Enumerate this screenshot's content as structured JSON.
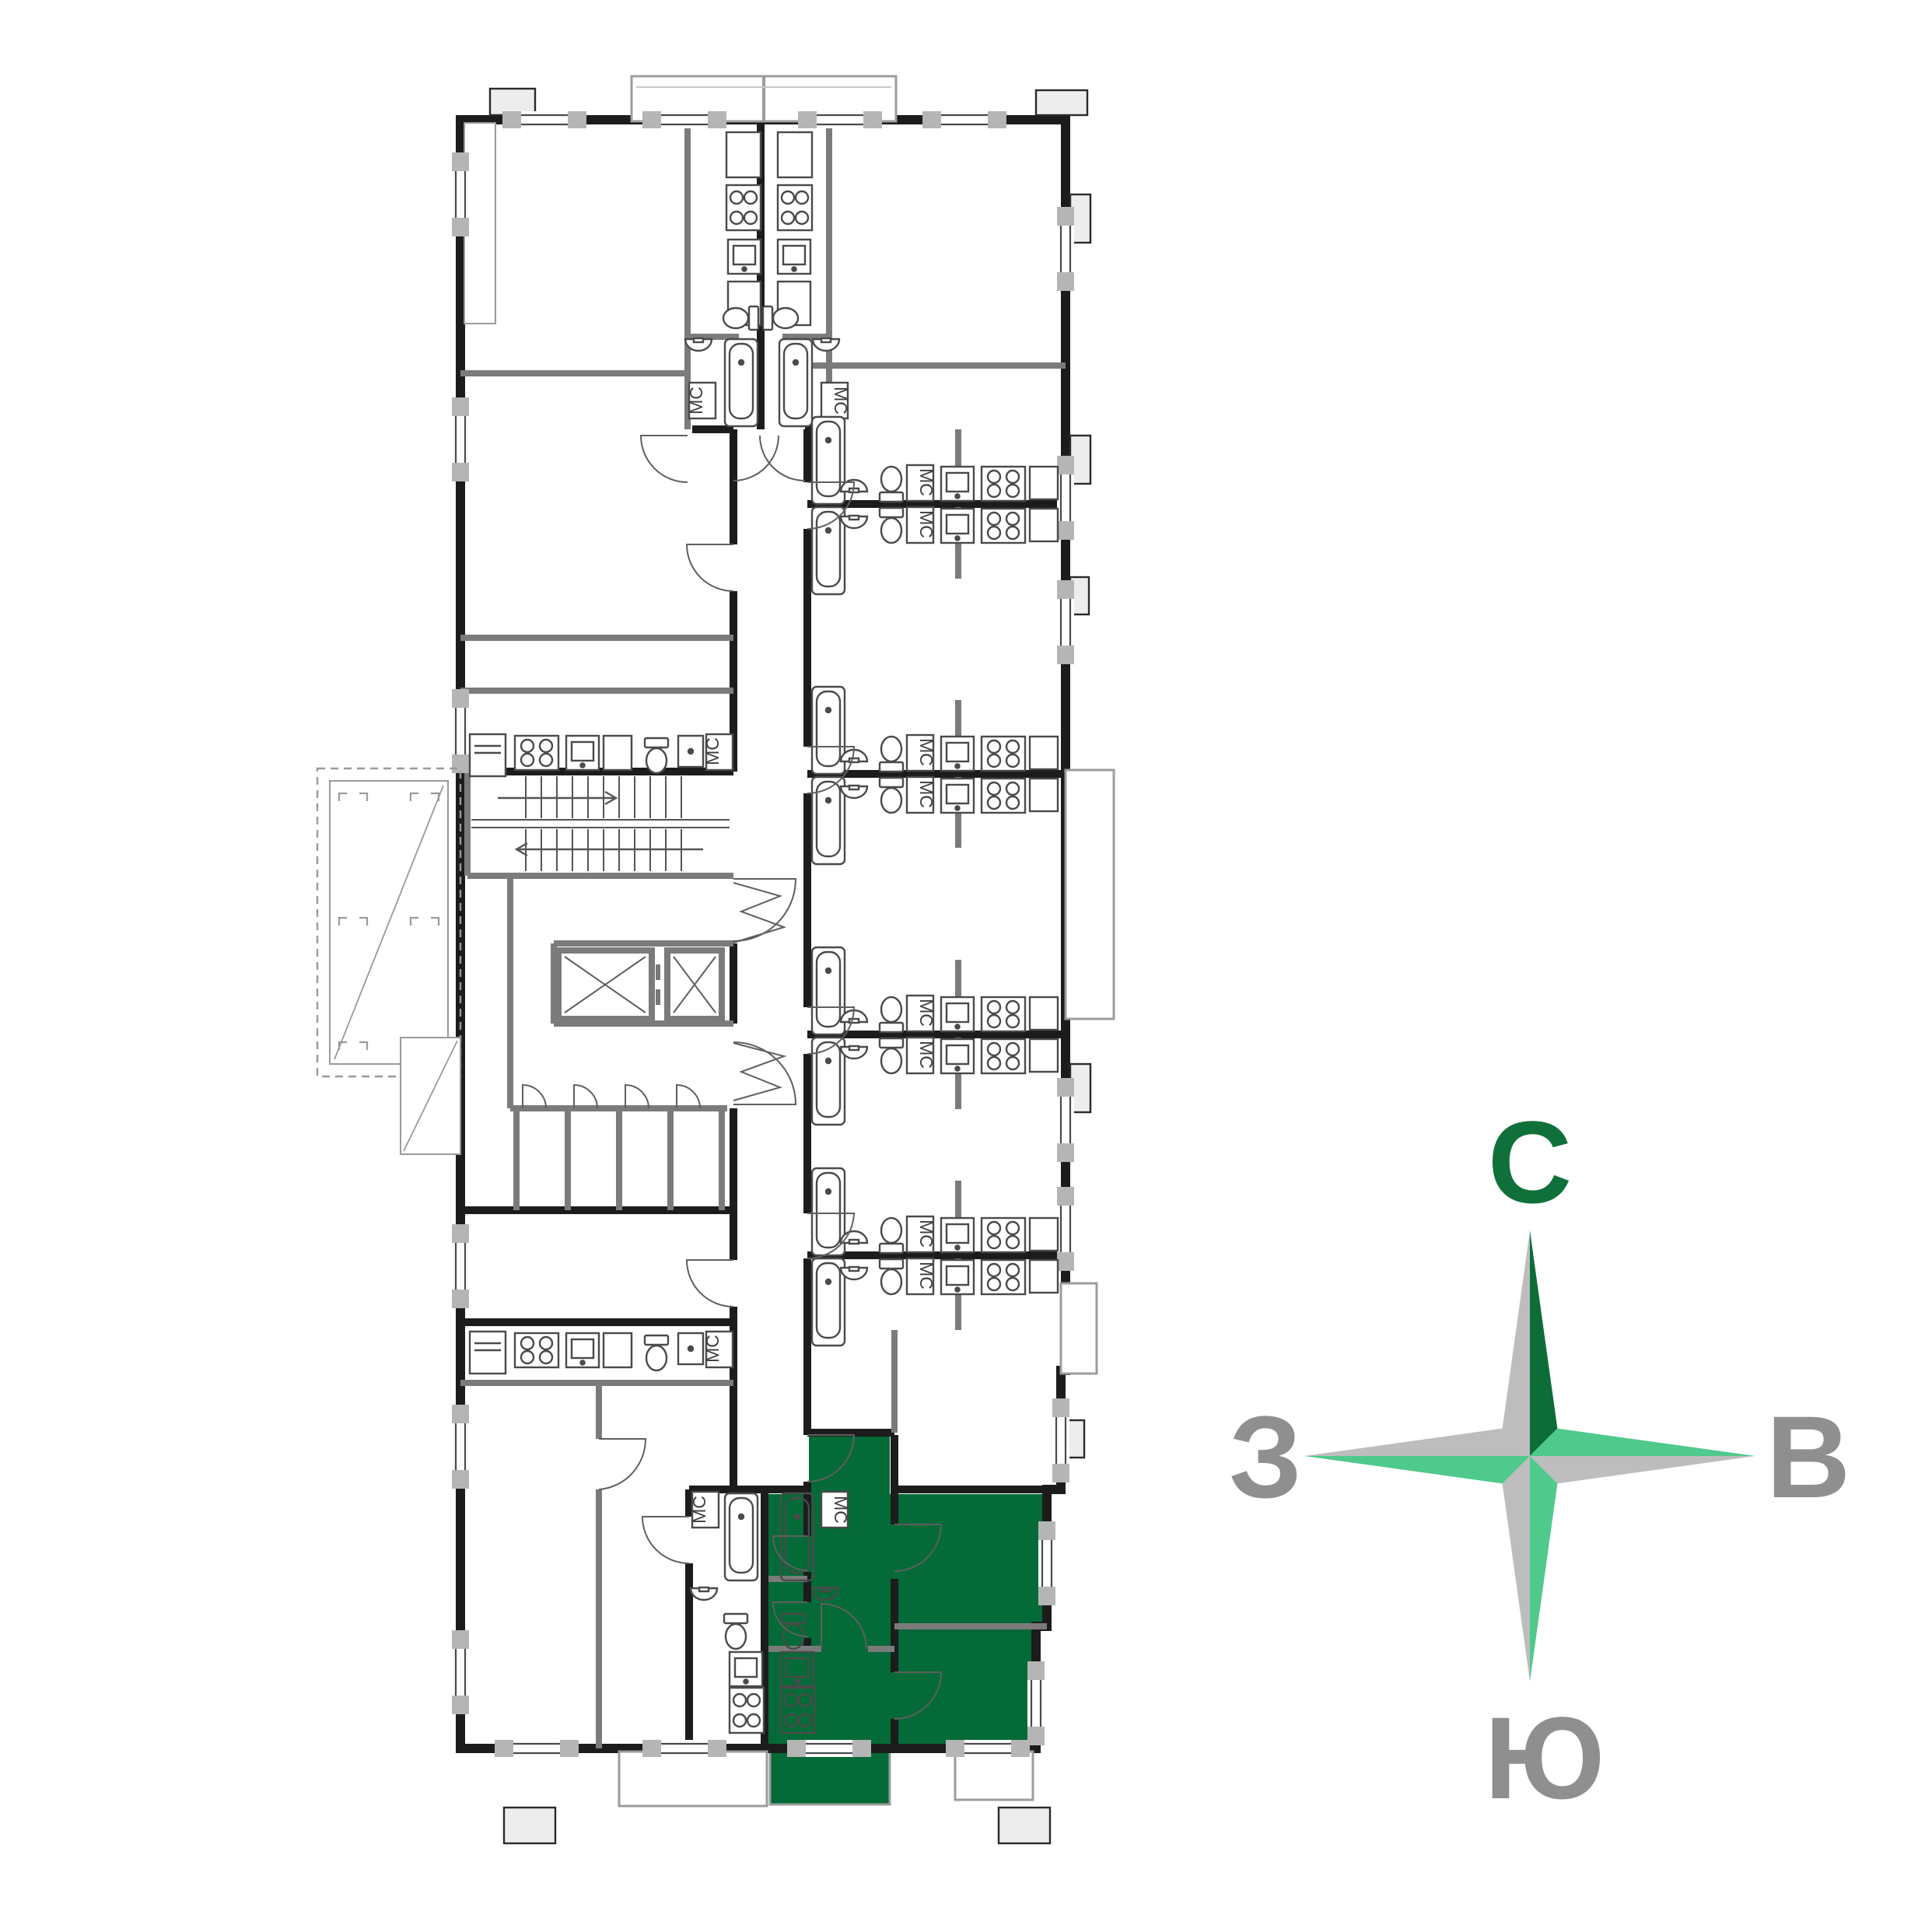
{
  "plan": {
    "labels": {
      "washing_machine": "МС"
    },
    "highlight_color": "#046a38",
    "colors": {
      "exterior_wall": "#1c1c1c",
      "interior_wall": "#7b7b7b",
      "window_pier": "#b5b5b5",
      "fixture_outline": "#4a4a4a",
      "balcony_outline": "#9c9c9c",
      "tab_fill": "#ededed"
    }
  },
  "compass": {
    "labels": {
      "north": "С",
      "east": "В",
      "west": "З",
      "south": "Ю"
    },
    "colors": {
      "north_letter": "#10703a",
      "other_letters": "#8f8f8f",
      "star_gray": "#bdbdbd",
      "star_dark_green": "#0d6d39",
      "star_light_green": "#4fc98c"
    }
  }
}
